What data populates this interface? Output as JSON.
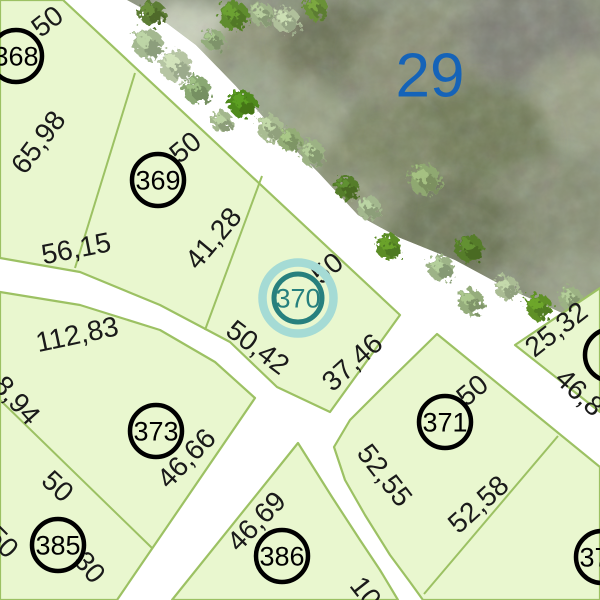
{
  "map": {
    "colors": {
      "road": "#ffffff",
      "parcel_fill": "#e9f7cf",
      "boundary": "#9cc163",
      "label": "#1a1a1a",
      "lot_circle": "#000000",
      "block_number_blue": "#1563b8",
      "highlight_ring": "#a5dbd5",
      "highlight_stroke": "#27807e",
      "imagery_base": "#8b937c"
    },
    "block_number": {
      "text": "29",
      "x": 430,
      "y": 75
    },
    "parcels": [
      {
        "id": "block-368-369-370",
        "points": [
          [
            0,
            0
          ],
          [
            63,
            0
          ],
          [
            400,
            315
          ],
          [
            330,
            412
          ],
          [
            277,
            387
          ],
          [
            230,
            342
          ],
          [
            160,
            305
          ],
          [
            80,
            272
          ],
          [
            0,
            258
          ]
        ]
      },
      {
        "id": "block-373-385",
        "points": [
          [
            0,
            292
          ],
          [
            80,
            305
          ],
          [
            160,
            330
          ],
          [
            215,
            362
          ],
          [
            255,
            398
          ],
          [
            117,
            600
          ],
          [
            0,
            600
          ]
        ]
      },
      {
        "id": "block-386",
        "points": [
          [
            298,
            443
          ],
          [
            332,
            497
          ],
          [
            360,
            540
          ],
          [
            380,
            570
          ],
          [
            398,
            600
          ],
          [
            172,
            600
          ]
        ]
      },
      {
        "id": "block-371-372",
        "points": [
          [
            437,
            334
          ],
          [
            600,
            467
          ],
          [
            600,
            600
          ],
          [
            423,
            600
          ],
          [
            410,
            582
          ],
          [
            390,
            555
          ],
          [
            365,
            515
          ],
          [
            345,
            480
          ],
          [
            334,
            447
          ],
          [
            350,
            420
          ],
          [
            390,
            380
          ]
        ]
      },
      {
        "id": "block-northeast",
        "points": [
          [
            515,
            345
          ],
          [
            600,
            288
          ],
          [
            600,
            412
          ]
        ]
      }
    ],
    "inner_lines": [
      {
        "points": [
          [
            135,
            73
          ],
          [
            75,
            268
          ]
        ]
      },
      {
        "points": [
          [
            262,
            176
          ],
          [
            205,
            330
          ]
        ]
      },
      {
        "points": [
          [
            0,
            400
          ],
          [
            152,
            548
          ]
        ]
      },
      {
        "points": [
          [
            558,
            436
          ],
          [
            424,
            594
          ]
        ]
      }
    ],
    "dimension_labels": [
      {
        "text": "50",
        "x": 47,
        "y": 21,
        "rot": -38
      },
      {
        "text": "65,98",
        "x": 38,
        "y": 142,
        "rot": -53
      },
      {
        "text": "50",
        "x": 185,
        "y": 147,
        "rot": -40
      },
      {
        "text": "41,28",
        "x": 213,
        "y": 238,
        "rot": -50
      },
      {
        "text": "56,15",
        "x": 76,
        "y": 248,
        "rot": -11
      },
      {
        "text": "50",
        "x": 327,
        "y": 268,
        "rot": -40
      },
      {
        "text": "50,42",
        "x": 258,
        "y": 347,
        "rot": 37
      },
      {
        "text": "37,46",
        "x": 352,
        "y": 362,
        "rot": -42
      },
      {
        "text": "112,83",
        "x": 77,
        "y": 334,
        "rot": -12
      },
      {
        "text": "8,94",
        "x": 17,
        "y": 400,
        "rot": 48
      },
      {
        "text": "46,66",
        "x": 186,
        "y": 458,
        "rot": -46
      },
      {
        "text": "50",
        "x": 58,
        "y": 486,
        "rot": 43
      },
      {
        "text": "50",
        "x": 3,
        "y": 542,
        "rot": 45
      },
      {
        "text": "30",
        "x": 90,
        "y": 567,
        "rot": 50
      },
      {
        "text": "46,69",
        "x": 256,
        "y": 521,
        "rot": -46
      },
      {
        "text": "10",
        "x": 366,
        "y": 592,
        "rot": 52
      },
      {
        "text": "52,55",
        "x": 385,
        "y": 475,
        "rot": 52
      },
      {
        "text": "52,58",
        "x": 478,
        "y": 504,
        "rot": -42
      },
      {
        "text": "50",
        "x": 472,
        "y": 390,
        "rot": -40
      },
      {
        "text": "25,32",
        "x": 556,
        "y": 329,
        "rot": -38
      },
      {
        "text": "46,8",
        "x": 580,
        "y": 392,
        "rot": 43
      }
    ],
    "lots": [
      {
        "number": "368",
        "x": 16,
        "y": 56,
        "highlighted": false
      },
      {
        "number": "369",
        "x": 158,
        "y": 180,
        "highlighted": false
      },
      {
        "number": "370",
        "x": 298,
        "y": 298,
        "highlighted": true
      },
      {
        "number": "371",
        "x": 445,
        "y": 422,
        "highlighted": false
      },
      {
        "number": "372",
        "x": 602,
        "y": 557,
        "highlighted": false
      },
      {
        "number": "373",
        "x": 156,
        "y": 431,
        "highlighted": false
      },
      {
        "number": "385",
        "x": 58,
        "y": 545,
        "highlighted": false
      },
      {
        "number": "386",
        "x": 282,
        "y": 556,
        "highlighted": false
      },
      {
        "number": "",
        "x": 611,
        "y": 355,
        "highlighted": false
      }
    ],
    "imagery": {
      "polygon": [
        [
          127,
          0
        ],
        [
          600,
          0
        ],
        [
          600,
          332
        ],
        [
          560,
          312
        ],
        [
          505,
          287
        ],
        [
          455,
          260
        ],
        [
          398,
          237
        ],
        [
          358,
          215
        ],
        [
          318,
          172
        ],
        [
          275,
          130
        ],
        [
          235,
          85
        ],
        [
          196,
          45
        ],
        [
          160,
          18
        ]
      ],
      "blobs": [
        {
          "x": 185,
          "y": 45,
          "rx": 60,
          "ry": 42,
          "c": "#c8cfba"
        },
        {
          "x": 265,
          "y": 62,
          "rx": 60,
          "ry": 45,
          "c": "#8f9478"
        },
        {
          "x": 335,
          "y": 42,
          "rx": 55,
          "ry": 40,
          "c": "#6e7558"
        },
        {
          "x": 420,
          "y": 62,
          "rx": 70,
          "ry": 55,
          "c": "#8b9074"
        },
        {
          "x": 532,
          "y": 38,
          "rx": 72,
          "ry": 55,
          "c": "#7f8175"
        },
        {
          "x": 583,
          "y": 102,
          "rx": 60,
          "ry": 50,
          "c": "#9aa085"
        },
        {
          "x": 470,
          "y": 142,
          "rx": 80,
          "ry": 60,
          "c": "#727b59"
        },
        {
          "x": 378,
          "y": 152,
          "rx": 60,
          "ry": 50,
          "c": "#7d8663"
        },
        {
          "x": 300,
          "y": 122,
          "rx": 48,
          "ry": 40,
          "c": "#99a184"
        },
        {
          "x": 552,
          "y": 222,
          "rx": 82,
          "ry": 62,
          "c": "#878e73"
        },
        {
          "x": 450,
          "y": 232,
          "rx": 70,
          "ry": 50,
          "c": "#6e7758"
        },
        {
          "x": 350,
          "y": 202,
          "rx": 50,
          "ry": 40,
          "c": "#8f9779"
        },
        {
          "x": 585,
          "y": 290,
          "rx": 50,
          "ry": 40,
          "c": "#98a086"
        },
        {
          "x": 240,
          "y": 100,
          "rx": 45,
          "ry": 40,
          "c": "#9aa58a"
        }
      ],
      "trees": [
        {
          "x": 152,
          "y": 13,
          "r": 13,
          "c": "#5d7d35"
        },
        {
          "x": 148,
          "y": 44,
          "r": 15,
          "c": "#a4b890"
        },
        {
          "x": 176,
          "y": 66,
          "r": 16,
          "c": "#b6c5a3"
        },
        {
          "x": 197,
          "y": 90,
          "r": 14,
          "c": "#8aa873"
        },
        {
          "x": 214,
          "y": 40,
          "r": 11,
          "c": "#93ac7c"
        },
        {
          "x": 234,
          "y": 16,
          "r": 15,
          "c": "#5e8c2d"
        },
        {
          "x": 262,
          "y": 14,
          "r": 12,
          "c": "#9fb389"
        },
        {
          "x": 287,
          "y": 21,
          "r": 13,
          "c": "#b0c09b"
        },
        {
          "x": 316,
          "y": 8,
          "r": 12,
          "c": "#6b9138"
        },
        {
          "x": 243,
          "y": 104,
          "r": 14,
          "c": "#4f8a1d"
        },
        {
          "x": 222,
          "y": 122,
          "r": 11,
          "c": "#a3b78d"
        },
        {
          "x": 270,
          "y": 128,
          "r": 13,
          "c": "#a9bc92"
        },
        {
          "x": 290,
          "y": 140,
          "r": 12,
          "c": "#93ad76"
        },
        {
          "x": 312,
          "y": 153,
          "r": 13,
          "c": "#9cb284"
        },
        {
          "x": 347,
          "y": 188,
          "r": 12,
          "c": "#557d2a"
        },
        {
          "x": 369,
          "y": 208,
          "r": 12,
          "c": "#a3b88e"
        },
        {
          "x": 389,
          "y": 247,
          "r": 13,
          "c": "#5c8d26"
        },
        {
          "x": 425,
          "y": 180,
          "r": 16,
          "c": "#8fa871"
        },
        {
          "x": 441,
          "y": 268,
          "r": 13,
          "c": "#9db387"
        },
        {
          "x": 470,
          "y": 249,
          "r": 14,
          "c": "#567d2b"
        },
        {
          "x": 471,
          "y": 302,
          "r": 13,
          "c": "#95ad7c"
        },
        {
          "x": 507,
          "y": 288,
          "r": 12,
          "c": "#aabc94"
        },
        {
          "x": 539,
          "y": 307,
          "r": 13,
          "c": "#5f9026"
        },
        {
          "x": 571,
          "y": 299,
          "r": 12,
          "c": "#9cb284"
        },
        {
          "x": 594,
          "y": 321,
          "r": 10,
          "c": "#8aa778"
        }
      ]
    }
  }
}
